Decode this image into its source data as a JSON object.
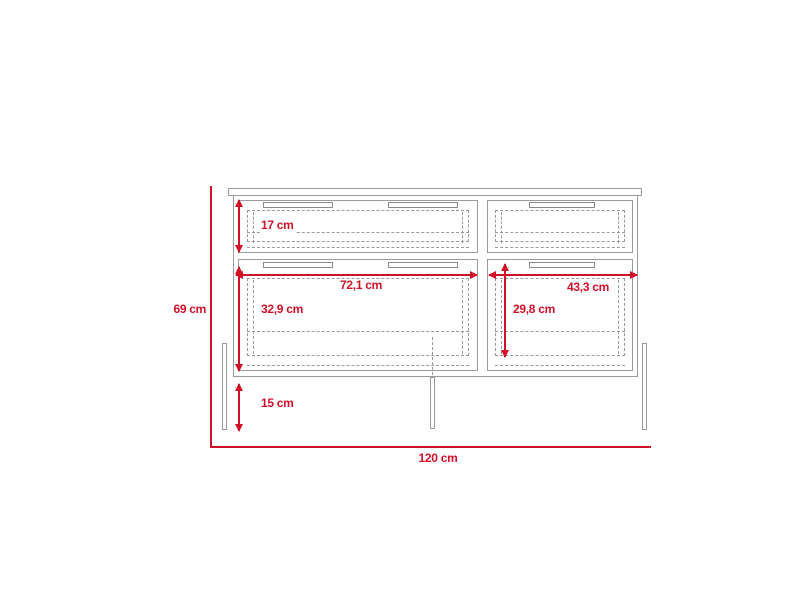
{
  "diagram": {
    "unit": "cm",
    "colors": {
      "accent": "#d01128",
      "outline": "#9b9b9b",
      "handle": "#8a8a8a",
      "background": "#ffffff"
    },
    "labels": {
      "total_height": "69 cm",
      "total_width": "120 cm",
      "top_drawer_height": "17 cm",
      "left_drawer_width": "72,1 cm",
      "right_drawer_width": "43,3 cm",
      "bottom_left_drawer_height": "32,9 cm",
      "bottom_right_drawer_height": "29,8 cm",
      "leg_height": "15 cm"
    }
  }
}
